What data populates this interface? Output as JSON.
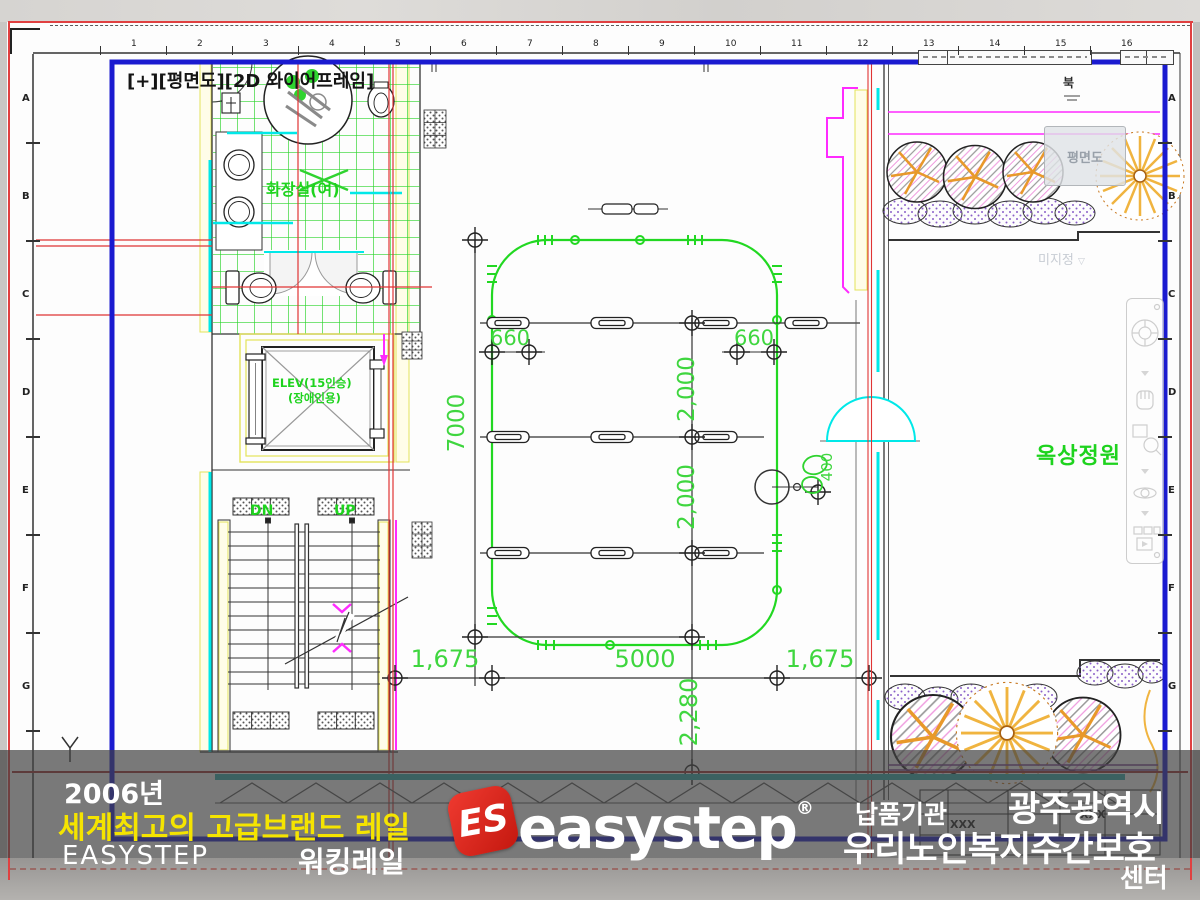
{
  "window": {
    "viewport_label": "[+][평면도][2D 와이어프레임]"
  },
  "plan": {
    "labels": {
      "restroom": "화장실(여)",
      "elevator_line1": "ELEV(15인승)",
      "elevator_line2": "(장애인용)",
      "stair_down": "DN",
      "stair_up": "UP",
      "roof_garden": "옥상정원",
      "view_tooltip": "평면도",
      "unassigned": "미지정",
      "unassigned_chevron": "▽",
      "north": "북"
    },
    "dimensions": {
      "left_offset_660": "660",
      "right_offset_660": "660",
      "rail_length_7000": "7000",
      "bay_2000_upper": "2,000",
      "bay_2000_lower": "2,000",
      "door_400": "400",
      "bottom_left_1675": "1,675",
      "bottom_center_5000": "5000",
      "bottom_right_1675": "1,675",
      "bottom_2280": "2,280"
    },
    "ruler": {
      "top_numbers": [
        "1",
        "2",
        "3",
        "4",
        "5",
        "6",
        "7",
        "8",
        "9",
        "10",
        "11",
        "12",
        "13",
        "14",
        "15",
        "16"
      ],
      "side_letters": [
        "A",
        "B",
        "C",
        "D",
        "E",
        "F",
        "G"
      ]
    },
    "titleblock": {
      "cell1": "XXX",
      "cell2": "XXX"
    }
  },
  "overlay": {
    "year": "2006년",
    "tagline": "세계최고의 고급브랜드 레일",
    "brand": "EASYSTEP",
    "product": "워킹레일",
    "logo": {
      "monogram": "ES",
      "wordmark": "easystep",
      "registered": "®"
    },
    "client": {
      "label": "납품기관",
      "org_city": "광주광역시",
      "org_name": "우리노인복지주간보호",
      "org_name_tail": "센터"
    }
  },
  "colors": {
    "frame_blue": "#1a1ad0",
    "cad_green": "#22d822",
    "dim_green": "#3fd63f",
    "cyan": "#00e8e8",
    "magenta": "#ff2bff",
    "red_line": "#e03434",
    "yellow_wall": "#e3e35a",
    "overlay_gray": "#404040",
    "logo_red": "#e2261f",
    "tagline_yellow": "#f5e400"
  }
}
